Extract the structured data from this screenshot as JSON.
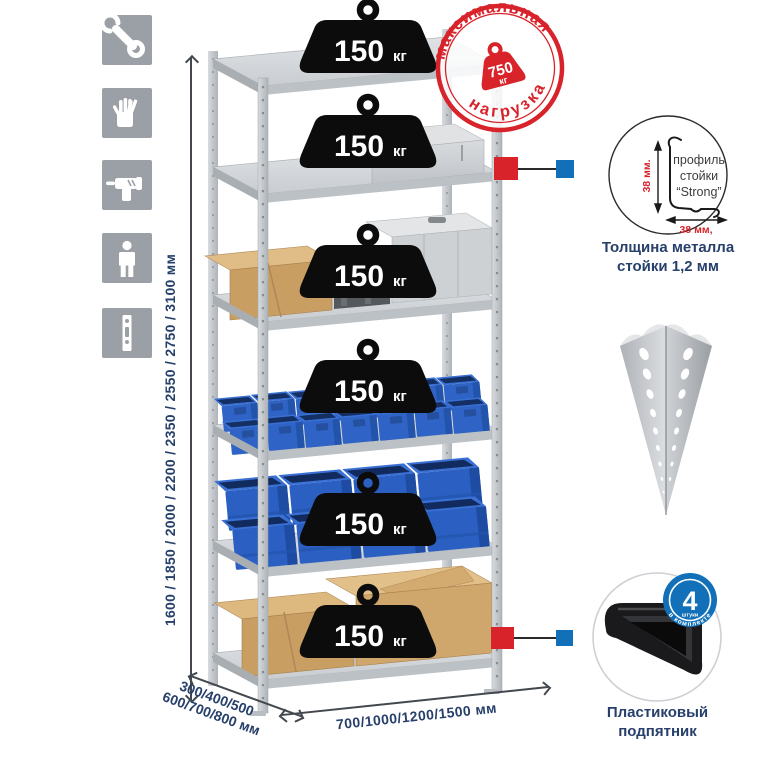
{
  "icons": {
    "items": [
      {
        "name": "wrench"
      },
      {
        "name": "gloves"
      },
      {
        "name": "drill"
      },
      {
        "name": "person"
      },
      {
        "name": "perforated-post"
      }
    ]
  },
  "dimensions": {
    "height_label": "1600 / 1850 / 2000 / 2200 / 2350 / 2550 / 2750 / 3100 мм",
    "depth_line1": "300/400/500",
    "depth_line2": "600/700/800 мм",
    "width_label": "700/1000/1200/1500 мм"
  },
  "rack": {
    "shelf_loads": [
      {
        "value": "150",
        "unit": "кг"
      },
      {
        "value": "150",
        "unit": "кг"
      },
      {
        "value": "150",
        "unit": "кг"
      },
      {
        "value": "150",
        "unit": "кг"
      },
      {
        "value": "150",
        "unit": "кг"
      },
      {
        "value": "150",
        "unit": "кг"
      }
    ]
  },
  "stamp": {
    "arc_top": "максимальная",
    "arc_bottom": "нагрузка",
    "value": "750",
    "unit": "кг"
  },
  "profile": {
    "line1": "профиль",
    "line2": "стойки",
    "line3": "“Strong”",
    "dim_vertical": "38 мм.",
    "dim_horizontal": "38 мм,",
    "caption_line1": "Толщина металла",
    "caption_line2": "стойки 1,2 мм"
  },
  "foot": {
    "badge_value": "4",
    "badge_sub": "штуки",
    "badge_arc": "в комплекте",
    "caption_line1": "Пластиковый",
    "caption_line2": "подпятник"
  },
  "colors": {
    "red": "#d8232a",
    "blue": "#1270b8",
    "navy": "#27406b",
    "icon_gray": "#9aa0a5",
    "bin_blue": "#2f63c5"
  }
}
